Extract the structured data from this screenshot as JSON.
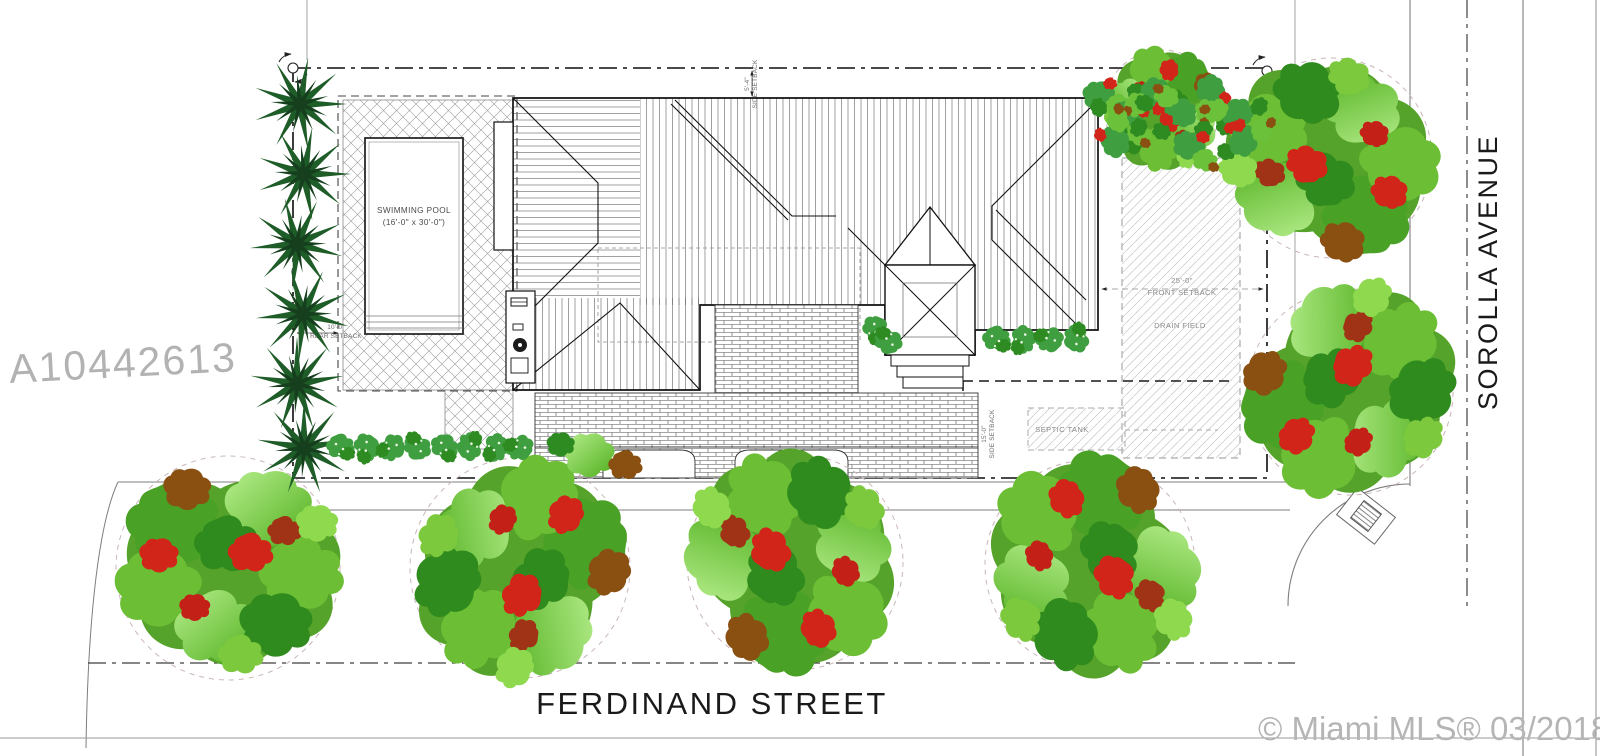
{
  "streets": {
    "ferdinand": "FERDINAND STREET",
    "sorolla": "SOROLLA AVENUE"
  },
  "watermarks": {
    "listing_id": "A10442613",
    "mls": "© Miami MLS® 03/2018"
  },
  "pool": {
    "name": "SWIMMING POOL",
    "dims": "(16'-0\" x 30'-0\")"
  },
  "site": {
    "drain_field": "DRAIN FIELD",
    "septic_tank": "SEPTIC TANK",
    "fire_hydrant": "FH"
  },
  "setbacks": {
    "front": {
      "dim": "25'-0\"",
      "label": "FRONT SETBACK"
    },
    "side_south": {
      "dim": "15'-0\"",
      "label": "SIDE SETBACK"
    },
    "side_north": {
      "dim": "5'-4\"",
      "label": "SIDE SETBACK"
    },
    "rear": {
      "dim": "10'-0\"",
      "label": "REAR SETBACK"
    }
  },
  "colors": {
    "linework": "#1a1a1a",
    "street_line": "#7d7d7d",
    "annotation_gray": "#8a8a8a",
    "watermark": "#b2b2b2",
    "tree_green": "#55a32a",
    "tree_light_green": "#8fd94f",
    "tree_red": "#d1251a",
    "tree_brown": "#8a5012",
    "palm_green": "#1e5c28",
    "shrub_green": "#3f9e3f"
  }
}
